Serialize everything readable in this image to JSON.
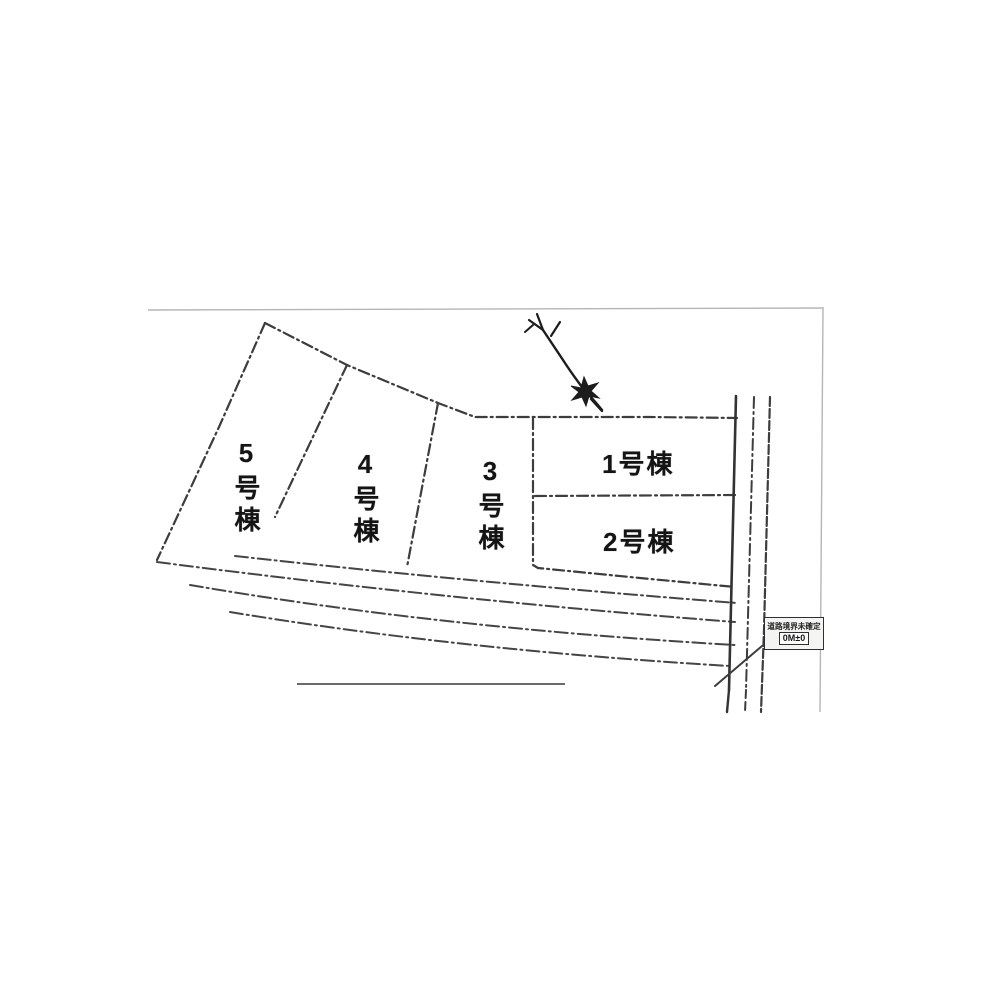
{
  "site_plan": {
    "lots": [
      {
        "name": "lot-1",
        "label": "1号棟"
      },
      {
        "name": "lot-2",
        "label": "2号棟"
      },
      {
        "name": "lot-3",
        "label": "3号棟"
      },
      {
        "name": "lot-4",
        "label": "4号棟"
      },
      {
        "name": "lot-5",
        "label": "5号棟"
      }
    ],
    "annotation_box": {
      "line1": "道路境界未確定",
      "line2": "0M±0"
    },
    "icons": {
      "north_arrow": "north-arrow-icon"
    },
    "colors": {
      "line": "#3d3d3d",
      "frame": "#b5b5b5",
      "text": "#141414",
      "background": "#ffffff"
    }
  }
}
